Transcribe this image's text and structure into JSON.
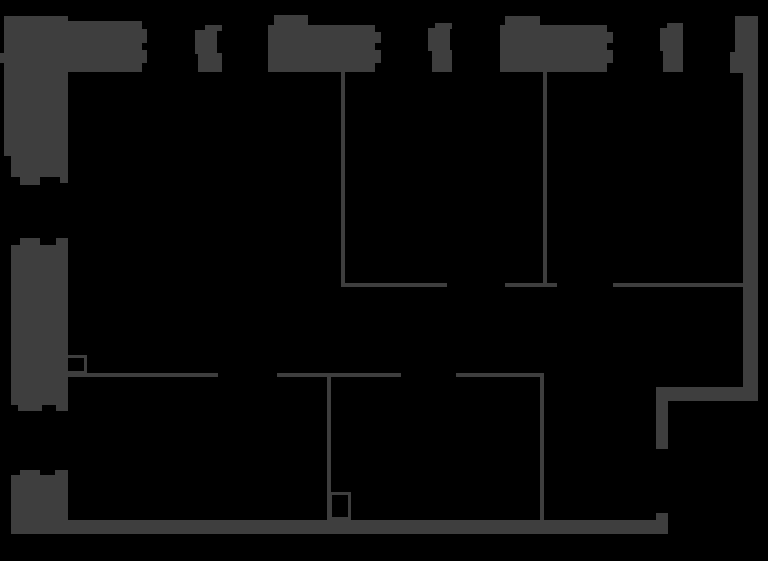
{
  "floorplan": {
    "title": "floor-plan",
    "canvas": {
      "width": 768,
      "height": 561
    },
    "background_color": "#000000",
    "wall_color": "#3e3e3e",
    "walls": [
      {
        "name": "top-left-corner-parapet",
        "x": 4,
        "y": 16,
        "w": 37,
        "h": 10
      },
      {
        "name": "top-band-left",
        "x": 4,
        "y": 21,
        "w": 138,
        "h": 51
      },
      {
        "name": "top-band-left-jamb-upper",
        "x": 142,
        "y": 29,
        "w": 5,
        "h": 14
      },
      {
        "name": "top-band-left-jamb-lower",
        "x": 142,
        "y": 50,
        "w": 5,
        "h": 13
      },
      {
        "name": "left-edge-stub",
        "x": 0,
        "y": 53,
        "w": 5,
        "h": 10
      },
      {
        "name": "left-wall-upper",
        "x": 4,
        "y": 16,
        "w": 64,
        "h": 140
      },
      {
        "name": "left-wall-upper-foot",
        "x": 11,
        "y": 156,
        "w": 57,
        "h": 21
      },
      {
        "name": "window-tooth",
        "x": 20,
        "y": 177,
        "w": 20,
        "h": 8
      },
      {
        "name": "window-tooth",
        "x": 60,
        "y": 177,
        "w": 8,
        "h": 6
      },
      {
        "name": "top-mullion-1-cap",
        "x": 205,
        "y": 25,
        "w": 17,
        "h": 6
      },
      {
        "name": "top-mullion-1-body",
        "x": 195,
        "y": 30,
        "w": 22,
        "h": 24
      },
      {
        "name": "top-mullion-1-base",
        "x": 198,
        "y": 53,
        "w": 24,
        "h": 19
      },
      {
        "name": "top-block-1-tab",
        "x": 274,
        "y": 15,
        "w": 34,
        "h": 10
      },
      {
        "name": "top-block-1",
        "x": 268,
        "y": 25,
        "w": 107,
        "h": 47
      },
      {
        "name": "top-block-1-jamb-upper",
        "x": 375,
        "y": 32,
        "w": 6,
        "h": 11
      },
      {
        "name": "top-block-1-jamb-lower",
        "x": 375,
        "y": 50,
        "w": 6,
        "h": 13
      },
      {
        "name": "top-mullion-2-cap",
        "x": 435,
        "y": 23,
        "w": 17,
        "h": 6
      },
      {
        "name": "top-mullion-2-body",
        "x": 428,
        "y": 28,
        "w": 22,
        "h": 23
      },
      {
        "name": "top-mullion-2-base",
        "x": 432,
        "y": 50,
        "w": 20,
        "h": 22
      },
      {
        "name": "top-block-2-tab",
        "x": 505,
        "y": 16,
        "w": 35,
        "h": 9
      },
      {
        "name": "top-block-2",
        "x": 500,
        "y": 25,
        "w": 107,
        "h": 47
      },
      {
        "name": "top-block-2-jamb-upper",
        "x": 607,
        "y": 32,
        "w": 6,
        "h": 11
      },
      {
        "name": "top-block-2-jamb-lower",
        "x": 607,
        "y": 50,
        "w": 6,
        "h": 13
      },
      {
        "name": "top-mullion-3-cap",
        "x": 667,
        "y": 23,
        "w": 16,
        "h": 6
      },
      {
        "name": "top-mullion-3-body",
        "x": 660,
        "y": 28,
        "w": 23,
        "h": 23
      },
      {
        "name": "top-mullion-3-base",
        "x": 663,
        "y": 50,
        "w": 20,
        "h": 22
      },
      {
        "name": "top-right-corner",
        "x": 735,
        "y": 16,
        "w": 23,
        "h": 57
      },
      {
        "name": "top-right-protrusion",
        "x": 730,
        "y": 52,
        "w": 5,
        "h": 21
      },
      {
        "name": "right-wall",
        "x": 743,
        "y": 73,
        "w": 15,
        "h": 328
      },
      {
        "name": "right-jog-horizontal",
        "x": 656,
        "y": 387,
        "w": 101,
        "h": 14
      },
      {
        "name": "right-jog-vertical",
        "x": 656,
        "y": 387,
        "w": 12,
        "h": 62
      },
      {
        "name": "bottom-right-stub",
        "x": 656,
        "y": 513,
        "w": 12,
        "h": 21
      },
      {
        "name": "bottom-wall",
        "x": 11,
        "y": 520,
        "w": 657,
        "h": 14
      },
      {
        "name": "left-wall-mid",
        "x": 11,
        "y": 245,
        "w": 57,
        "h": 160
      },
      {
        "name": "window-tooth",
        "x": 20,
        "y": 238,
        "w": 20,
        "h": 7
      },
      {
        "name": "window-tooth",
        "x": 56,
        "y": 238,
        "w": 12,
        "h": 7
      },
      {
        "name": "window-tooth",
        "x": 18,
        "y": 405,
        "w": 24,
        "h": 6
      },
      {
        "name": "window-tooth",
        "x": 56,
        "y": 405,
        "w": 12,
        "h": 6
      },
      {
        "name": "left-wall-lower",
        "x": 11,
        "y": 475,
        "w": 57,
        "h": 59
      },
      {
        "name": "window-tooth",
        "x": 20,
        "y": 470,
        "w": 20,
        "h": 5
      },
      {
        "name": "window-tooth",
        "x": 55,
        "y": 470,
        "w": 13,
        "h": 5
      },
      {
        "name": "partition-vertical-1",
        "x": 341,
        "y": 72,
        "w": 4,
        "h": 215
      },
      {
        "name": "partition-vertical-2",
        "x": 543,
        "y": 72,
        "w": 4,
        "h": 215
      },
      {
        "name": "partition-mid-horizontal-a",
        "x": 341,
        "y": 283,
        "w": 106,
        "h": 4
      },
      {
        "name": "partition-mid-horizontal-b",
        "x": 505,
        "y": 283,
        "w": 52,
        "h": 4
      },
      {
        "name": "partition-mid-horizontal-c",
        "x": 613,
        "y": 283,
        "w": 132,
        "h": 4
      },
      {
        "name": "partition-lower-horizontal-a",
        "x": 68,
        "y": 373,
        "w": 150,
        "h": 4
      },
      {
        "name": "partition-lower-horizontal-b",
        "x": 277,
        "y": 373,
        "w": 124,
        "h": 4
      },
      {
        "name": "partition-lower-horizontal-c",
        "x": 456,
        "y": 373,
        "w": 88,
        "h": 4
      },
      {
        "name": "partition-vertical-3",
        "x": 327,
        "y": 373,
        "w": 4,
        "h": 147
      },
      {
        "name": "partition-vertical-4",
        "x": 540,
        "y": 373,
        "w": 4,
        "h": 147
      }
    ],
    "outlined_boxes": [
      {
        "name": "fixture-box-left",
        "x": 62,
        "y": 355,
        "w": 25,
        "h": 19,
        "stroke": 3
      },
      {
        "name": "fixture-box-bottom",
        "x": 329,
        "y": 492,
        "w": 22,
        "h": 28,
        "stroke": 3
      }
    ]
  }
}
